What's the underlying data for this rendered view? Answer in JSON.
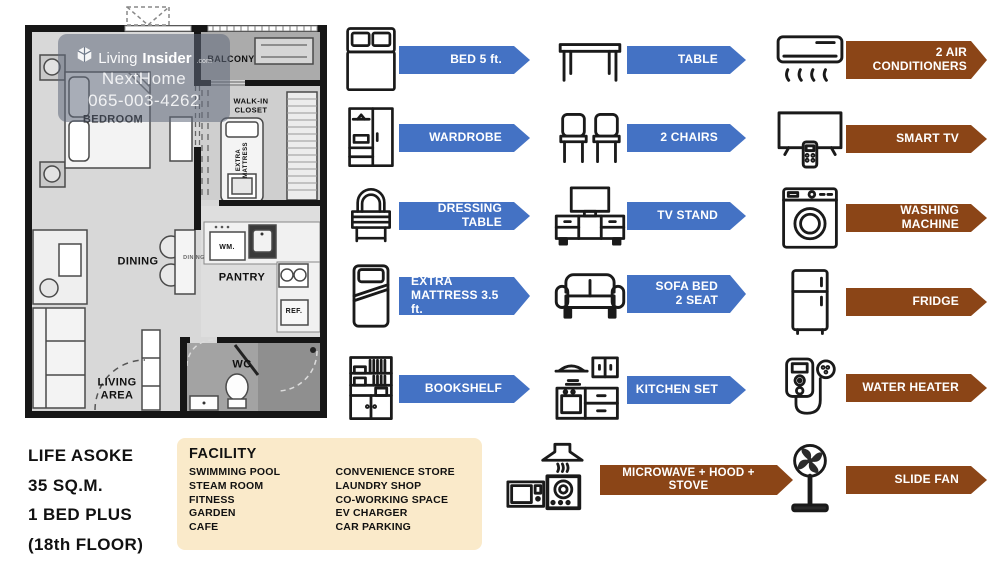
{
  "watermark": {
    "logo_text_light": "Living",
    "logo_text_bold": "Insider",
    "logo_suffix": ".com",
    "agent": "NextHome",
    "phone": "065-003-4262"
  },
  "plan": {
    "balcony": "BALCONY",
    "bedroom": "BEDROOM",
    "walk_in_closet": "WALK-IN\nCLOSET",
    "extra_mattress": "EXTRA\nMATTRESS",
    "dining": "DINING",
    "dining_table": "DINING",
    "pantry": "PANTRY",
    "washer": "WM.",
    "fridge": "REF.",
    "living_area": "LIVING\nAREA",
    "wc": "WC"
  },
  "unit": {
    "project": "LIFE ASOKE",
    "area": "35 SQ.M.",
    "layout": "1 BED PLUS",
    "floor": "(18th FLOOR)"
  },
  "facility": {
    "title": "FACILITY",
    "col1": [
      "SWIMMING POOL",
      "STEAM ROOM",
      "FITNESS",
      "GARDEN",
      "CAFE"
    ],
    "col2": [
      "CONVENIENCE STORE",
      "LAUNDRY SHOP",
      "CO-WORKING SPACE",
      "EV CHARGER",
      "CAR PARKING"
    ]
  },
  "furniture": {
    "col1": [
      {
        "icon": "bed-icon",
        "label": "BED 5 ft."
      },
      {
        "icon": "wardrobe-icon",
        "label": "WARDROBE"
      },
      {
        "icon": "dressing-table-icon",
        "label": "DRESSING TABLE"
      },
      {
        "icon": "extra-mattress-icon",
        "label": "EXTRA\nMATTRESS 3.5 ft."
      },
      {
        "icon": "bookshelf-icon",
        "label": "BOOKSHELF"
      }
    ],
    "col2": [
      {
        "icon": "table-icon",
        "label": "TABLE"
      },
      {
        "icon": "chairs-icon",
        "label": "2 CHAIRS"
      },
      {
        "icon": "tv-stand-icon",
        "label": "TV STAND"
      },
      {
        "icon": "sofa-bed-icon",
        "label": "SOFA BED\n2 SEAT"
      },
      {
        "icon": "kitchen-set-icon",
        "label": "KITCHEN SET"
      },
      {
        "icon": "microwave-hood-stove-icon",
        "label": "MICROWAVE + HOOD + STOVE"
      }
    ],
    "col3": [
      {
        "icon": "air-conditioner-icon",
        "label": "2 AIR\nCONDITIONERS"
      },
      {
        "icon": "smart-tv-icon",
        "label": "SMART TV"
      },
      {
        "icon": "washing-machine-icon",
        "label": "WASHING MACHINE"
      },
      {
        "icon": "fridge-icon",
        "label": "FRIDGE"
      },
      {
        "icon": "water-heater-icon",
        "label": "WATER HEATER"
      },
      {
        "icon": "slide-fan-icon",
        "label": "SLIDE FAN"
      }
    ]
  },
  "colors": {
    "arrow_blue": "#4472C4",
    "arrow_brown": "#8B4517",
    "facility_bg": "#FAEACA",
    "wall": "#161616"
  }
}
